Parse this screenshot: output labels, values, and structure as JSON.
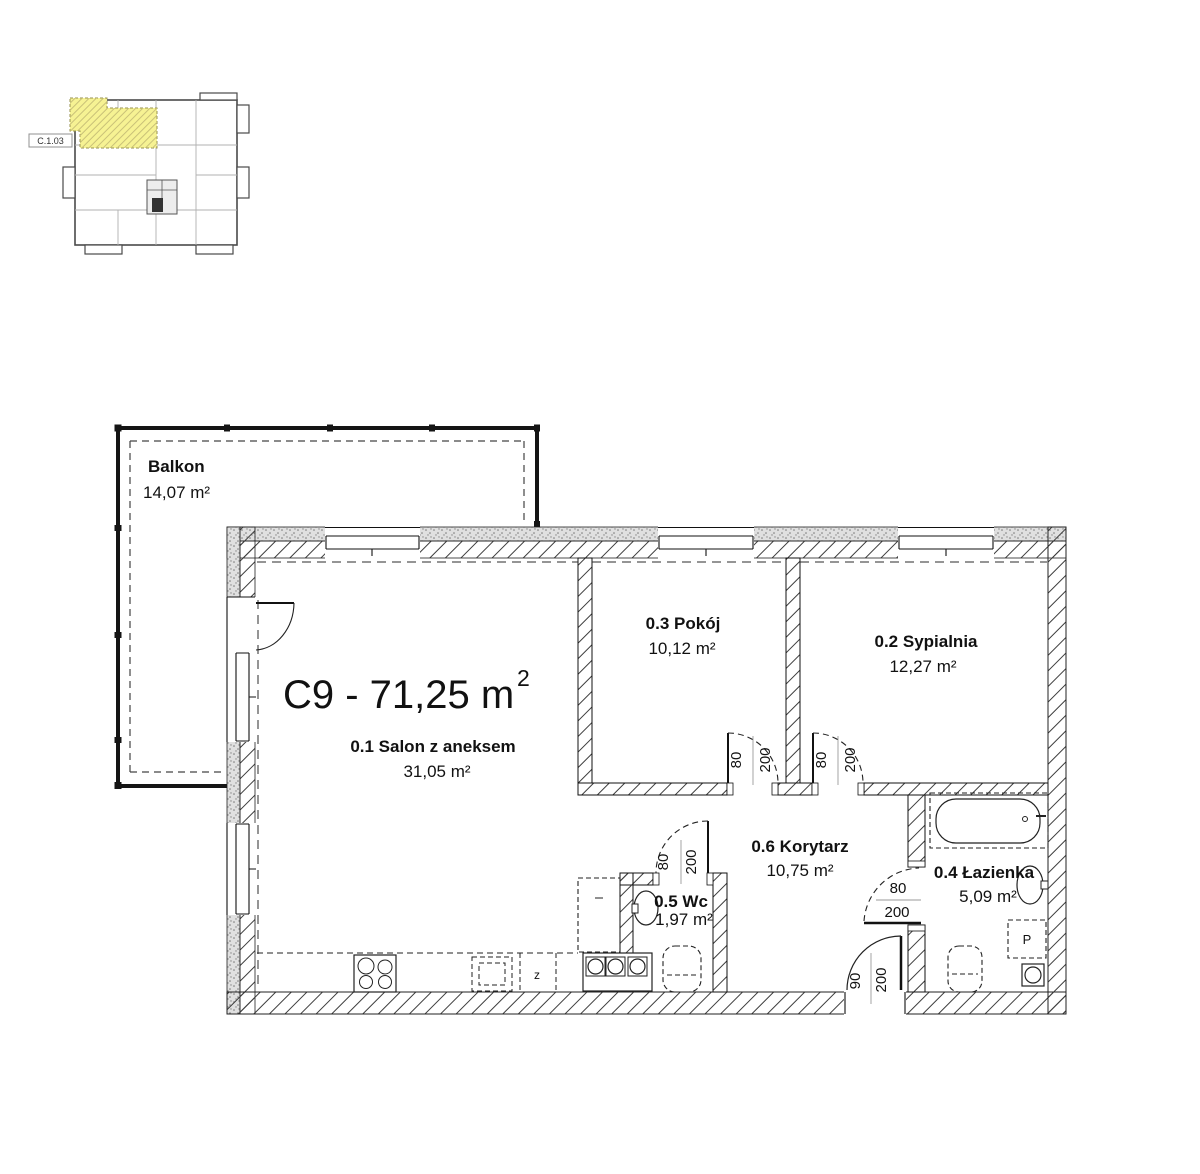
{
  "overview_map": {
    "unit_label": "C.1.03"
  },
  "title": {
    "main": "C9 - 71,25 m",
    "sup": "2"
  },
  "balcony": {
    "name": "Balkon",
    "area": "14,07 m²"
  },
  "rooms": {
    "salon": {
      "name": "0.1 Salon z aneksem",
      "area": "31,05 m²"
    },
    "sypialnia": {
      "name": "0.2 Sypialnia",
      "area": "12,27 m²"
    },
    "pokoj": {
      "name": "0.3 Pokój",
      "area": "10,12 m²"
    },
    "lazienka": {
      "name": "0.4 Łazienka",
      "area": "5,09 m²"
    },
    "wc": {
      "name": "0.5 Wc",
      "area": "1,97 m²"
    },
    "korytarz": {
      "name": "0.6 Korytarz",
      "area": "10,75 m²"
    }
  },
  "doors": {
    "pokoj": {
      "width": "80",
      "height": "200"
    },
    "sypialnia": {
      "width": "80",
      "height": "200"
    },
    "wc": {
      "width": "80",
      "height": "200"
    },
    "lazienka": {
      "width": "80",
      "height": "200"
    },
    "entrance": {
      "width": "90",
      "height": "200"
    }
  },
  "appliances": {
    "washer": "P",
    "dishwasher": "z"
  },
  "colors": {
    "unit_highlight": "#F6F293",
    "line": "#1a1a1a"
  }
}
